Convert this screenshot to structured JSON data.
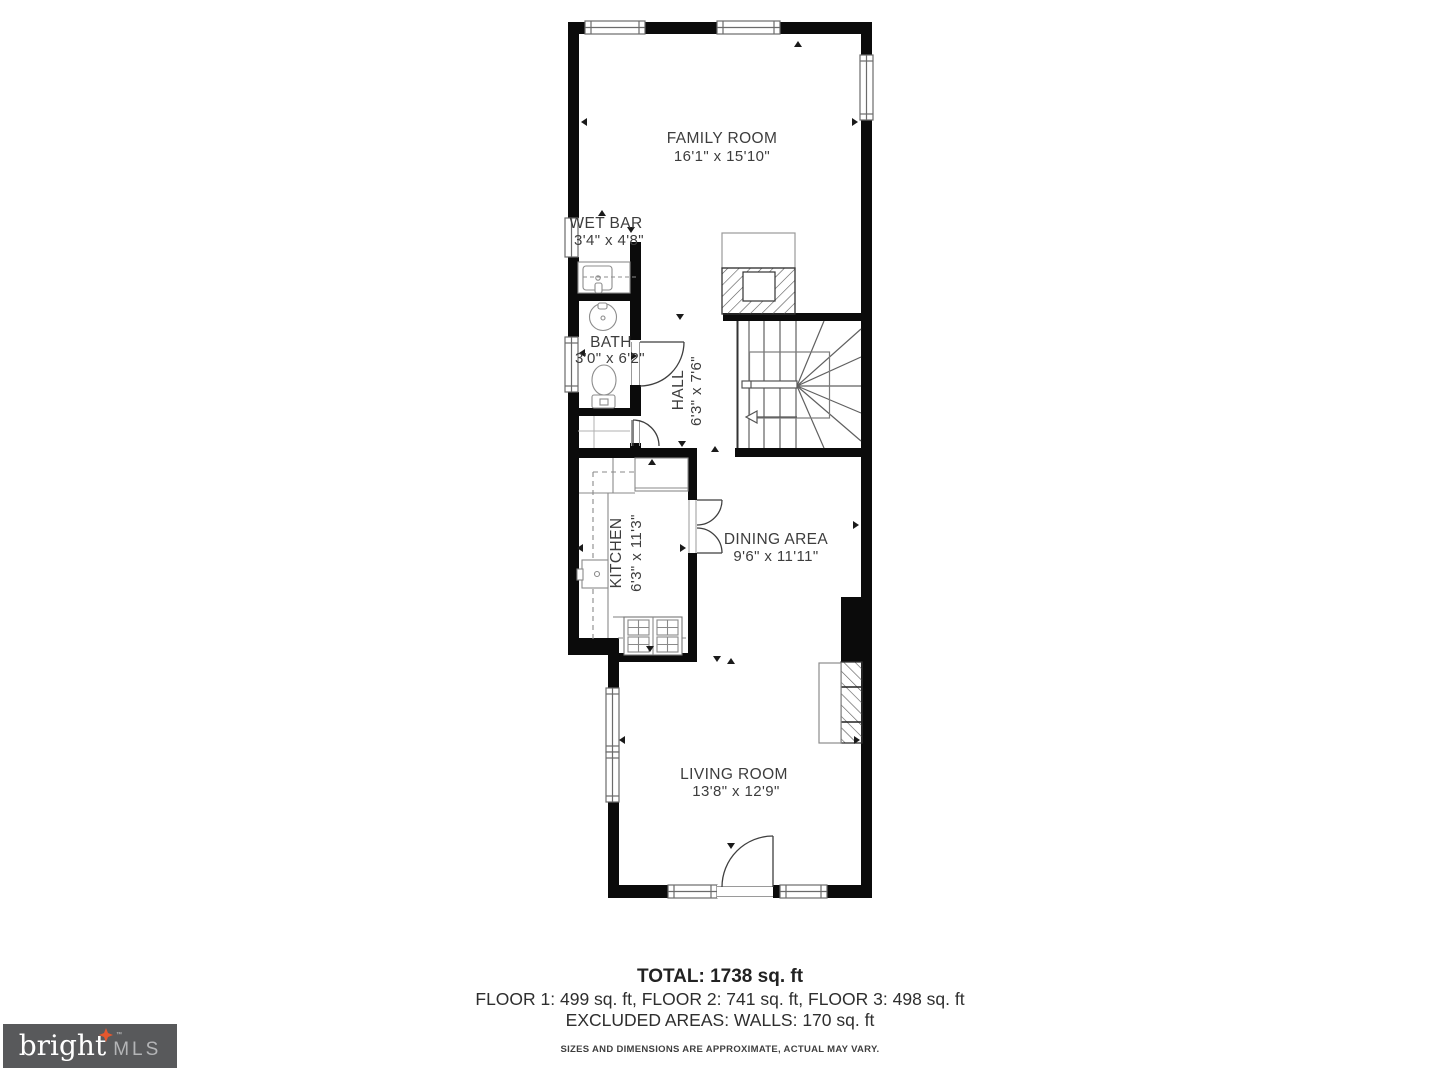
{
  "rooms": {
    "family_room": {
      "name": "FAMILY ROOM",
      "dims": "16'1\" x 15'10\""
    },
    "wet_bar": {
      "name": "WET BAR",
      "dims": "3'4\" x 4'8\""
    },
    "bath": {
      "name": "BATH",
      "dims": "3'0\" x 6'2\""
    },
    "hall": {
      "name": "HALL",
      "dims": "6'3\" x 7'6\""
    },
    "kitchen": {
      "name": "KITCHEN",
      "dims": "6'3\" x 11'3\""
    },
    "dining_area": {
      "name": "DINING AREA",
      "dims": "9'6\" x 11'11\""
    },
    "living_room": {
      "name": "LIVING ROOM",
      "dims": "13'8\" x 12'9\""
    }
  },
  "summary": {
    "total": "TOTAL: 1738 sq. ft",
    "floors": "FLOOR 1: 499 sq. ft, FLOOR 2: 741 sq. ft, FLOOR 3: 498 sq. ft",
    "excluded": "EXCLUDED AREAS: WALLS: 170 sq. ft",
    "disclaimer": "SIZES AND DIMENSIONS ARE APPROXIMATE, ACTUAL MAY VARY."
  },
  "logo": {
    "brand": "bright",
    "tm": "™",
    "suffix": "MLS"
  },
  "colors": {
    "wall": "#0b0b0b",
    "fixture": "#8d8d8d",
    "stair": "#606060",
    "door": "#3f3f3f",
    "text": "#3d3d3d",
    "logo_bg": "#58595B",
    "logo_star": "#E4572E",
    "logo_mls": "#B4B5B7"
  }
}
